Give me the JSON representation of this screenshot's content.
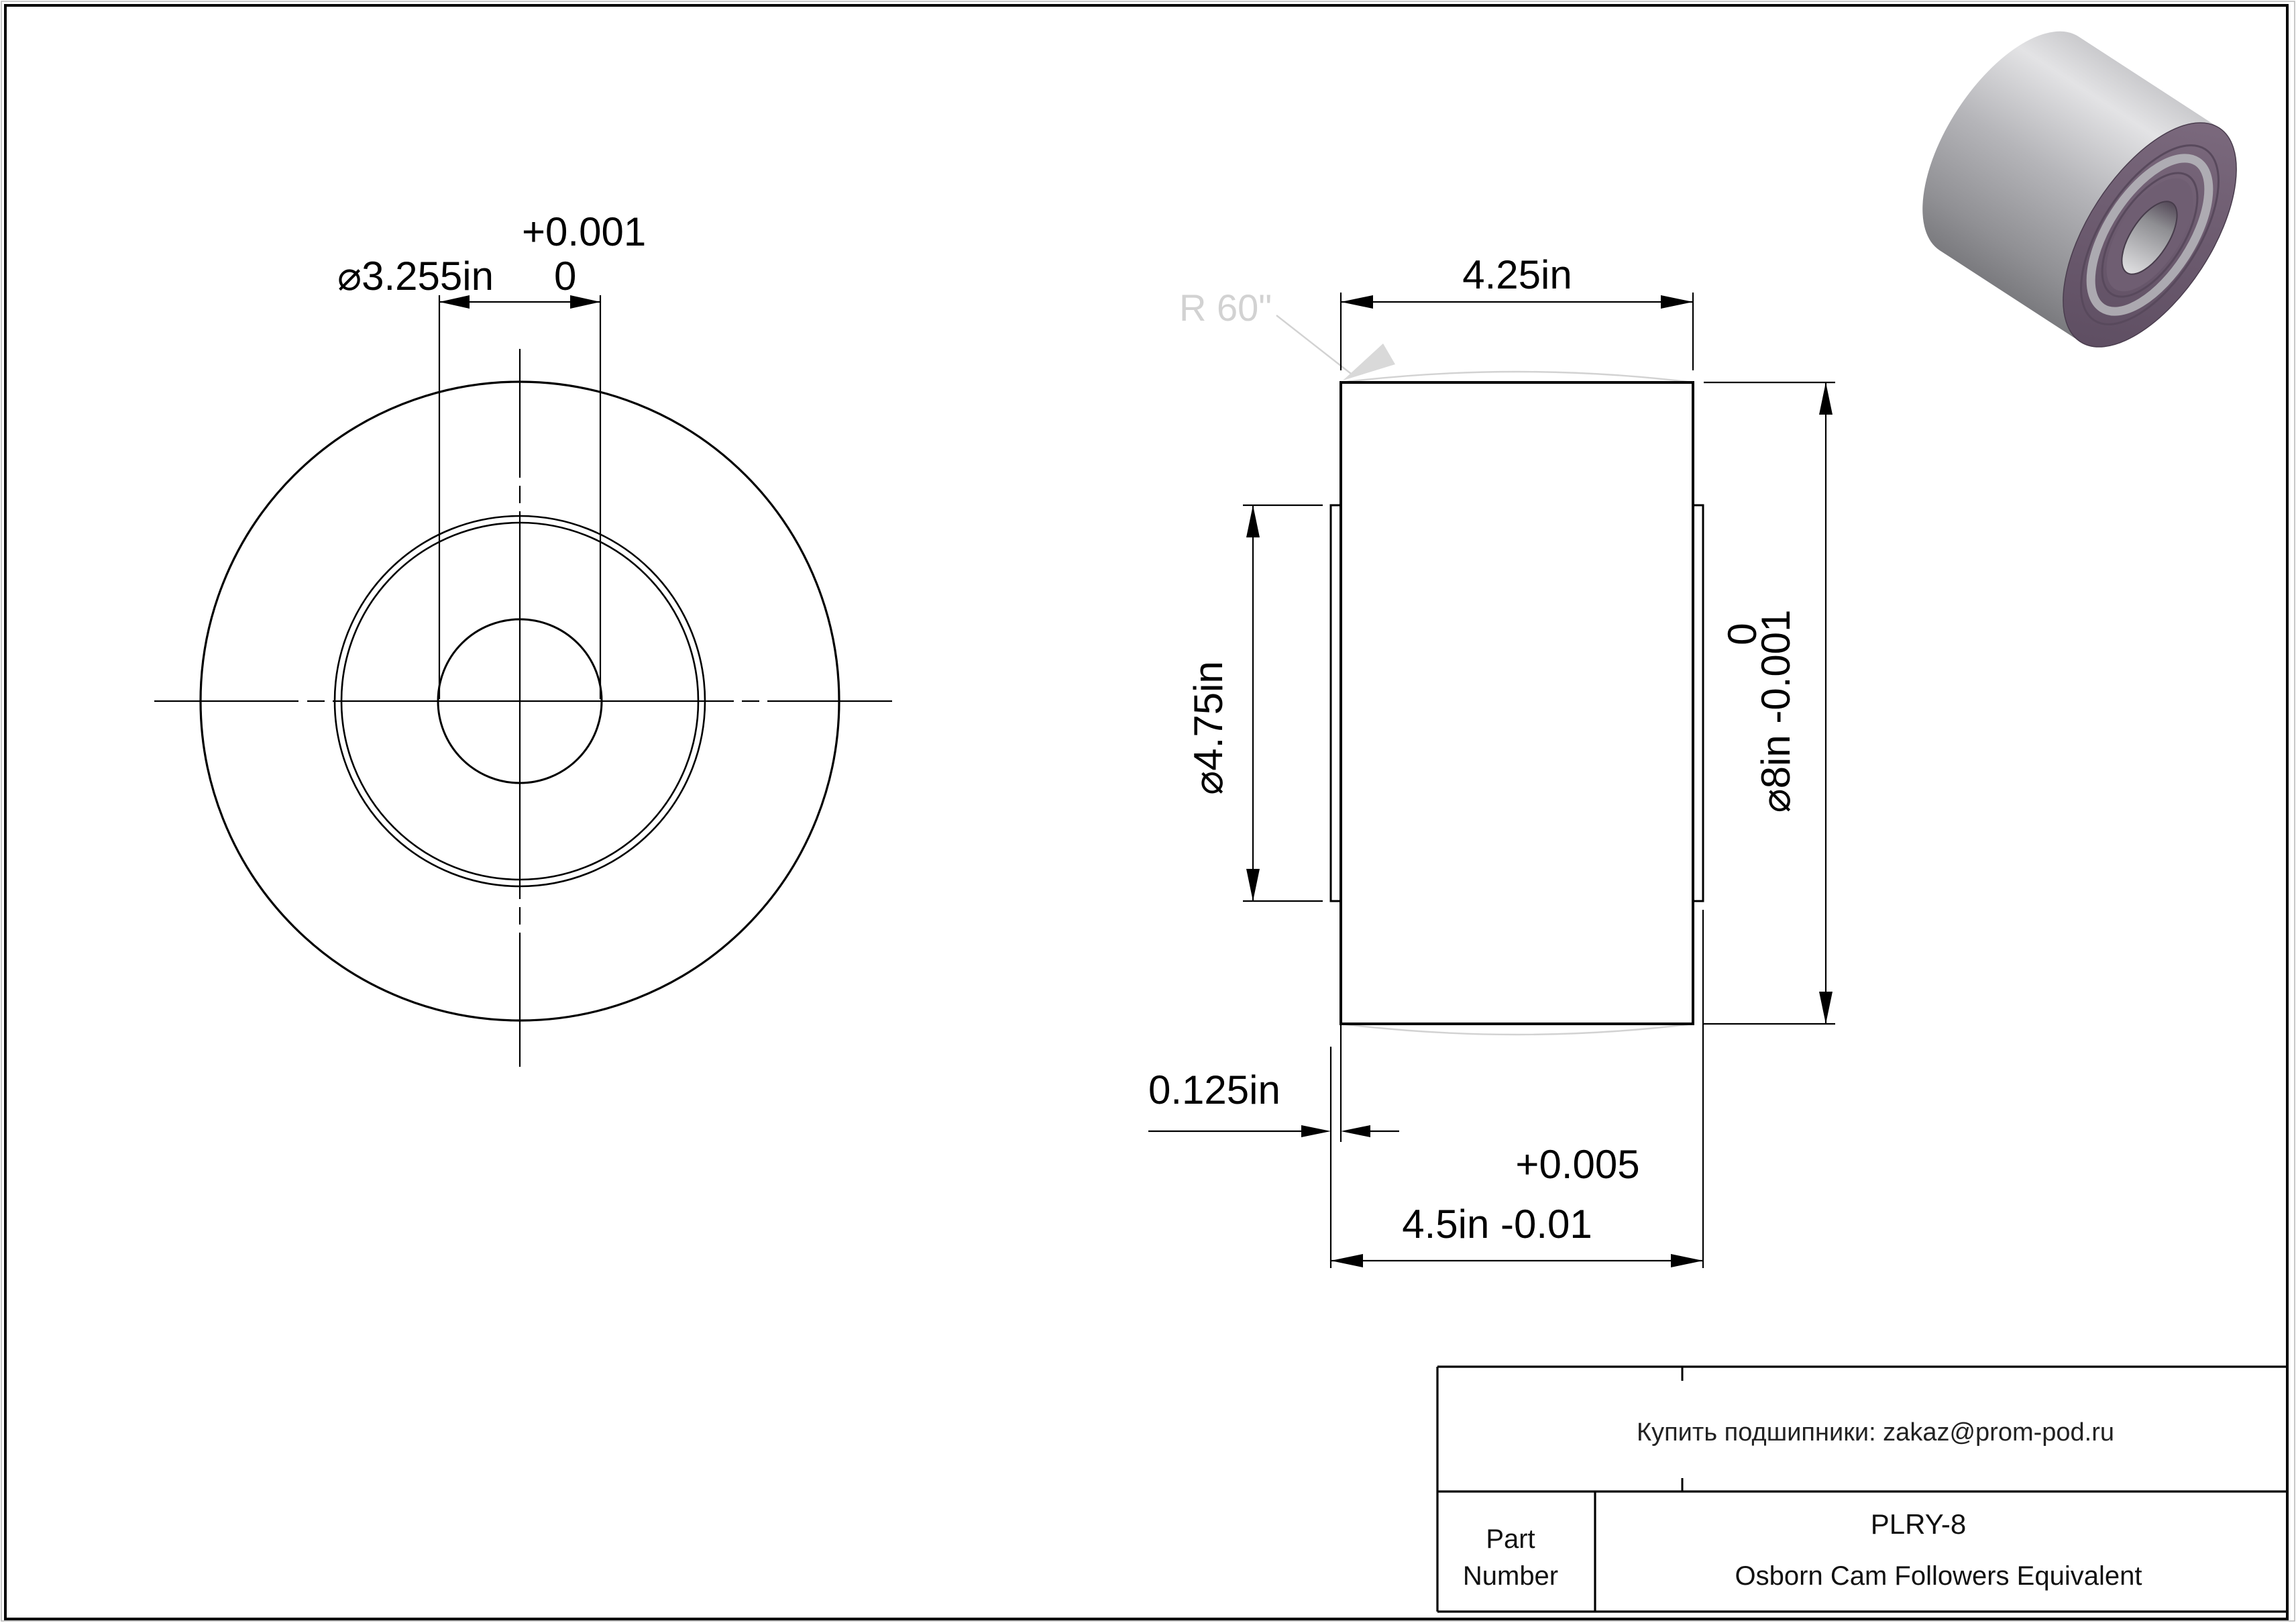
{
  "drawing": {
    "front_view": {
      "bore_dim": {
        "label": "⌀3.255in",
        "tol_upper": "+0.001",
        "tol_lower": "0"
      }
    },
    "side_view": {
      "width_dim": {
        "label": "4.25in"
      },
      "plate_dia_dim": {
        "label": "⌀4.75in"
      },
      "outer_dia_dim": {
        "label": "⌀8in -0.001",
        "tol_upper": "0"
      },
      "offset_dim": {
        "label": "0.125in"
      },
      "overall_width_dim": {
        "label": "4.5in -0.01",
        "tol_upper": "+0.005"
      },
      "crown_radius_label": "R 60\""
    },
    "title_block": {
      "contact_line": "Купить подшипники: zakaz@prom-pod.ru",
      "part_label_line1": "Part",
      "part_label_line2": "Number",
      "part_number": "PLRY-8",
      "subtitle": "Osborn Cam Followers Equivalent"
    },
    "colors": {
      "line": "#000000",
      "light_gray_annotation": "#d2d2d2",
      "render_body_silver": "#b9b9bd",
      "render_face_purple": "#6b5a6e"
    }
  }
}
